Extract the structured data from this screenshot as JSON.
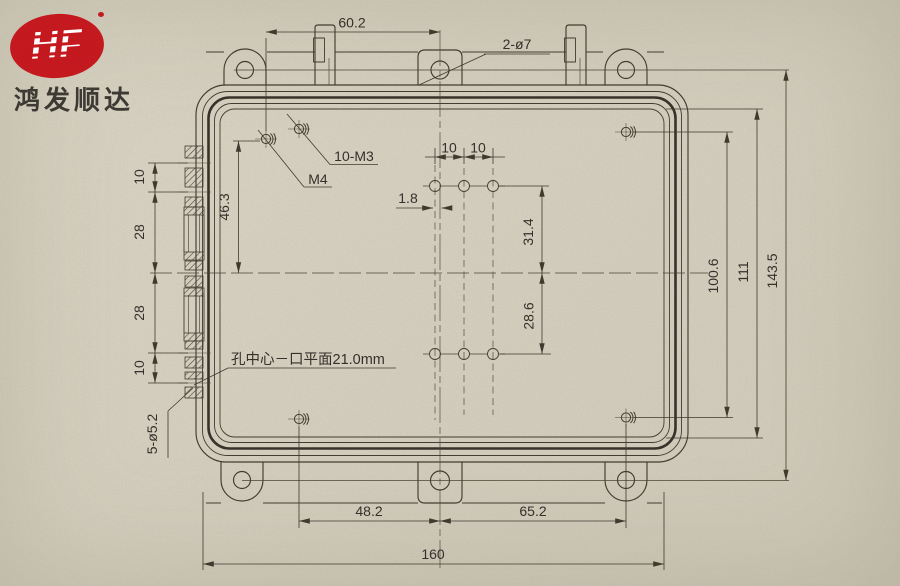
{
  "colors": {
    "paper": "#d6d1c1",
    "line": "#423d30",
    "text": "#34302a",
    "logo_red": "#c3191f"
  },
  "brand": {
    "logo_text": "HF",
    "company": "鸿发顺达"
  },
  "dims": {
    "top_width": "60.2",
    "top_tab_holes": "2-ø7",
    "lid_screws": "10-M3",
    "ground_screw": "M4",
    "pitch_a": "10",
    "pitch_b": "10",
    "offset_center": "1.8",
    "upper_left_height": "46.3",
    "pattern_upper": "31.4",
    "pattern_lower": "28.6",
    "right_inner": "100.6",
    "right_mid": "111",
    "right_outer": "143.5",
    "left_top": "10",
    "left_upper": "28",
    "left_lower": "28",
    "left_bottom": "10",
    "side_holes": "5-ø5.2",
    "bottom_left_span": "48.2",
    "bottom_right_span": "65.2",
    "overall_width": "160",
    "depth_note": "孔中心－口平面21.0mm"
  }
}
